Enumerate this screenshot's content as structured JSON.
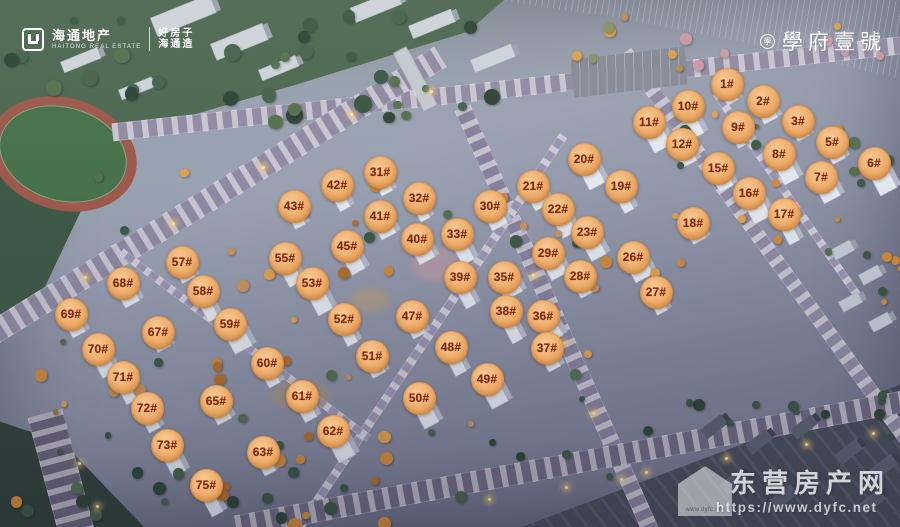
{
  "branding": {
    "developer": {
      "name": "海通地产",
      "name_en": "HAITONG REAL ESTATE",
      "slogan_line1": "好房子",
      "slogan_line2": "海通造"
    },
    "project": {
      "name": "學府壹號",
      "seal_char": "學"
    },
    "watermark": {
      "site_name": "东营房产网",
      "url": "https://www.dyfc.net",
      "house_label": "www.dyfc.net"
    }
  },
  "badge_style": {
    "fill_light": "#f8cb97",
    "fill_mid": "#edab68",
    "fill_dark": "#d98e4b",
    "text_color": "#7c2a10"
  },
  "badges": [
    {
      "label": "1#",
      "x": 727,
      "y": 84
    },
    {
      "label": "2#",
      "x": 763,
      "y": 101
    },
    {
      "label": "3#",
      "x": 798,
      "y": 121
    },
    {
      "label": "5#",
      "x": 832,
      "y": 142
    },
    {
      "label": "6#",
      "x": 874,
      "y": 163
    },
    {
      "label": "7#",
      "x": 821,
      "y": 177
    },
    {
      "label": "8#",
      "x": 779,
      "y": 154
    },
    {
      "label": "9#",
      "x": 738,
      "y": 127
    },
    {
      "label": "10#",
      "x": 688,
      "y": 106
    },
    {
      "label": "11#",
      "x": 649,
      "y": 122
    },
    {
      "label": "12#",
      "x": 682,
      "y": 144
    },
    {
      "label": "15#",
      "x": 718,
      "y": 168
    },
    {
      "label": "16#",
      "x": 749,
      "y": 193
    },
    {
      "label": "17#",
      "x": 784,
      "y": 214
    },
    {
      "label": "18#",
      "x": 693,
      "y": 223
    },
    {
      "label": "19#",
      "x": 621,
      "y": 186
    },
    {
      "label": "20#",
      "x": 584,
      "y": 159
    },
    {
      "label": "21#",
      "x": 533,
      "y": 186
    },
    {
      "label": "22#",
      "x": 558,
      "y": 209
    },
    {
      "label": "23#",
      "x": 587,
      "y": 232
    },
    {
      "label": "26#",
      "x": 633,
      "y": 257
    },
    {
      "label": "27#",
      "x": 656,
      "y": 292
    },
    {
      "label": "28#",
      "x": 580,
      "y": 276
    },
    {
      "label": "29#",
      "x": 548,
      "y": 253
    },
    {
      "label": "30#",
      "x": 490,
      "y": 206
    },
    {
      "label": "31#",
      "x": 380,
      "y": 172
    },
    {
      "label": "32#",
      "x": 419,
      "y": 198
    },
    {
      "label": "33#",
      "x": 457,
      "y": 234
    },
    {
      "label": "35#",
      "x": 504,
      "y": 277
    },
    {
      "label": "36#",
      "x": 543,
      "y": 316
    },
    {
      "label": "37#",
      "x": 547,
      "y": 348
    },
    {
      "label": "38#",
      "x": 506,
      "y": 311
    },
    {
      "label": "39#",
      "x": 460,
      "y": 277
    },
    {
      "label": "40#",
      "x": 417,
      "y": 239
    },
    {
      "label": "41#",
      "x": 380,
      "y": 216
    },
    {
      "label": "42#",
      "x": 337,
      "y": 185
    },
    {
      "label": "43#",
      "x": 294,
      "y": 206
    },
    {
      "label": "45#",
      "x": 347,
      "y": 246
    },
    {
      "label": "47#",
      "x": 412,
      "y": 316
    },
    {
      "label": "48#",
      "x": 451,
      "y": 347
    },
    {
      "label": "49#",
      "x": 487,
      "y": 379
    },
    {
      "label": "50#",
      "x": 419,
      "y": 398
    },
    {
      "label": "51#",
      "x": 372,
      "y": 356
    },
    {
      "label": "52#",
      "x": 344,
      "y": 319
    },
    {
      "label": "53#",
      "x": 312,
      "y": 283
    },
    {
      "label": "55#",
      "x": 285,
      "y": 258
    },
    {
      "label": "57#",
      "x": 182,
      "y": 262
    },
    {
      "label": "58#",
      "x": 203,
      "y": 291
    },
    {
      "label": "59#",
      "x": 230,
      "y": 324
    },
    {
      "label": "60#",
      "x": 267,
      "y": 363
    },
    {
      "label": "61#",
      "x": 302,
      "y": 396
    },
    {
      "label": "62#",
      "x": 333,
      "y": 431
    },
    {
      "label": "63#",
      "x": 263,
      "y": 452
    },
    {
      "label": "65#",
      "x": 216,
      "y": 401
    },
    {
      "label": "67#",
      "x": 158,
      "y": 332
    },
    {
      "label": "68#",
      "x": 123,
      "y": 283
    },
    {
      "label": "69#",
      "x": 71,
      "y": 314
    },
    {
      "label": "70#",
      "x": 98,
      "y": 349
    },
    {
      "label": "71#",
      "x": 123,
      "y": 377
    },
    {
      "label": "72#",
      "x": 147,
      "y": 408
    },
    {
      "label": "73#",
      "x": 167,
      "y": 445
    },
    {
      "label": "75#",
      "x": 206,
      "y": 485
    }
  ]
}
